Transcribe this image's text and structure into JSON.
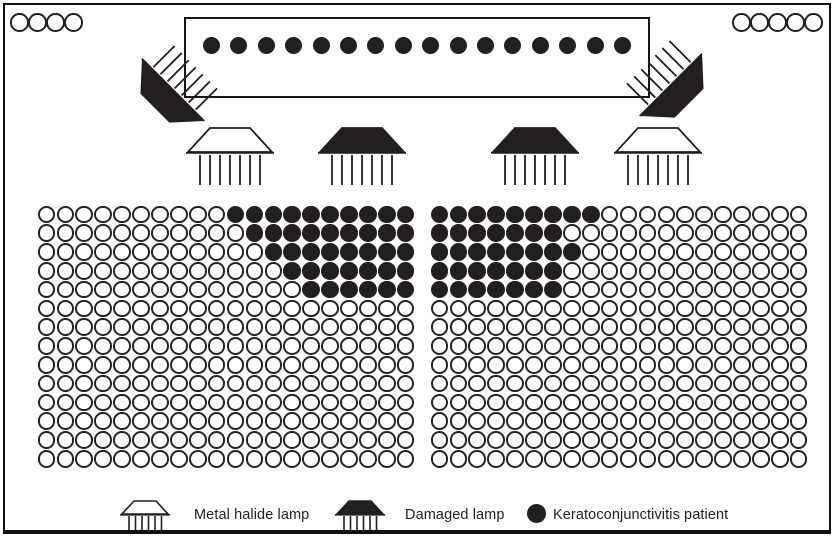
{
  "colors": {
    "ink": "#231f20",
    "background": "#ffffff"
  },
  "corner_markers": {
    "top_left_count": 4,
    "top_right_count": 5
  },
  "stage": {
    "patient_count": 16
  },
  "lamps": {
    "flanking": [
      {
        "position": "left",
        "type": "damaged-lamp"
      },
      {
        "position": "right",
        "type": "damaged-lamp"
      }
    ],
    "ceiling": [
      {
        "type": "metal-halide-lamp"
      },
      {
        "type": "damaged-lamp"
      },
      {
        "type": "damaged-lamp"
      },
      {
        "type": "metal-halide-lamp"
      }
    ]
  },
  "seating": {
    "rows": 14,
    "cols": 20,
    "left_block": {
      "patients_from_right_by_row": [
        10,
        9,
        8,
        7,
        6,
        0,
        0,
        0,
        0,
        0,
        0,
        0,
        0,
        0
      ]
    },
    "right_block": {
      "patients_from_left_by_row": [
        9,
        7,
        8,
        7,
        7,
        0,
        0,
        0,
        0,
        0,
        0,
        0,
        0,
        0
      ]
    }
  },
  "legend": {
    "items": [
      {
        "type": "metal-halide-lamp",
        "label": "Metal halide lamp"
      },
      {
        "type": "damaged-lamp",
        "label": "Damaged lamp"
      },
      {
        "type": "patient",
        "label": "Keratoconjunctivitis patient"
      }
    ]
  }
}
